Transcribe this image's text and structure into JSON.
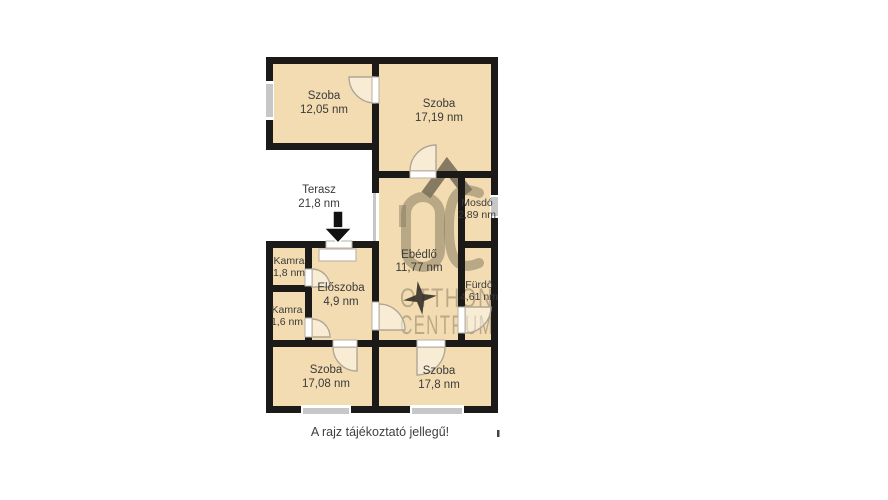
{
  "plan": {
    "disclaimer": "A rajz tájékoztató jellegű!",
    "stray_mark": "ı",
    "colors": {
      "room_fill": "#f3dcb1",
      "wall": "#1b1a18",
      "window": "#c7c7c7",
      "door_panel": "#ffffff",
      "door_swing": "#b0a696",
      "label": "#3a3a3a",
      "watermark": "#8d8269",
      "arrow": "#111111"
    },
    "rooms": [
      {
        "id": "szoba-1",
        "name": "Szoba",
        "area": "12,05 nm"
      },
      {
        "id": "szoba-2",
        "name": "Szoba",
        "area": "17,19 nm"
      },
      {
        "id": "terasz",
        "name": "Terasz",
        "area": "21,8 nm"
      },
      {
        "id": "mosdo",
        "name": "Mosdó",
        "area": "2,89 nm"
      },
      {
        "id": "ebedlo",
        "name": "Ebédlő",
        "area": "11,77 nm"
      },
      {
        "id": "kamra-1",
        "name": "Kamra",
        "area": "1,8 nm"
      },
      {
        "id": "eloszoba",
        "name": "Előszoba",
        "area": "4,9 nm"
      },
      {
        "id": "kamra-2",
        "name": "Kamra",
        "area": "1,6 nm"
      },
      {
        "id": "furdo",
        "name": "Fürdő",
        "area": "4,61 nm"
      },
      {
        "id": "szoba-3",
        "name": "Szoba",
        "area": "17,08 nm"
      },
      {
        "id": "szoba-4",
        "name": "Szoba",
        "area": "17,8 nm"
      }
    ],
    "watermark": {
      "logo": "OC",
      "line1": "OTTHON",
      "line2": "CENTRUM"
    }
  }
}
